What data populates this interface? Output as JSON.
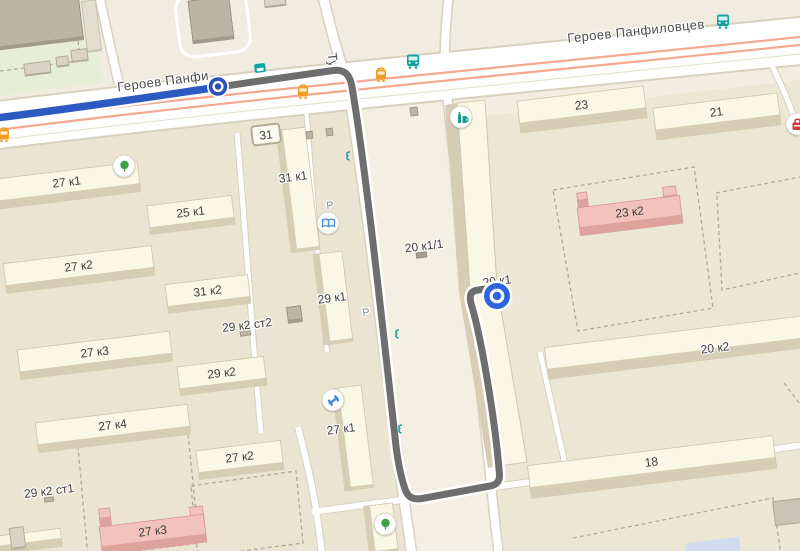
{
  "street_labels": {
    "main": "Героев Панфиловцев",
    "west": "Героев Панфи",
    "vertical": "Ту"
  },
  "buildings": {
    "h27k1": "27 к1",
    "h25k1": "25 к1",
    "h27k2": "27 к2",
    "h31k2": "31 к2",
    "h27k3": "27 к3",
    "h29k2": "29 к2",
    "h27k4": "27 к4",
    "h27k2b": "27 к2",
    "h27k3p": "27 к3",
    "h23": "23",
    "h21": "21",
    "h23k2": "23 к2",
    "h20k2": "20 к2",
    "h18": "18",
    "v31k1": "31 к1",
    "v29k1": "29 к1",
    "v27k1": "27 к1",
    "plate31": "31"
  },
  "area_labels": {
    "b20k1": "20 к1",
    "b20k11": "20 к1/1",
    "b29k2st2": "29 к2 ст2",
    "b29k2st1": "29 к2 ст1",
    "parking1": "P",
    "parking2": "P"
  },
  "colors": {
    "route_walk": "#6e6e6e",
    "route_ride": "#2d5ac1",
    "marker_blue": "#2d64dc",
    "tram_track": "#f5a78e",
    "transit_teal": "#12a1a1",
    "transit_orange": "#f09c1f",
    "poi_blue": "#4a8ad4",
    "poi_green": "#3fa146",
    "poi_red": "#d2383d",
    "building_face": "#faf7e6",
    "building_pink": "#f2c3bd",
    "land": "#f1ece0"
  }
}
